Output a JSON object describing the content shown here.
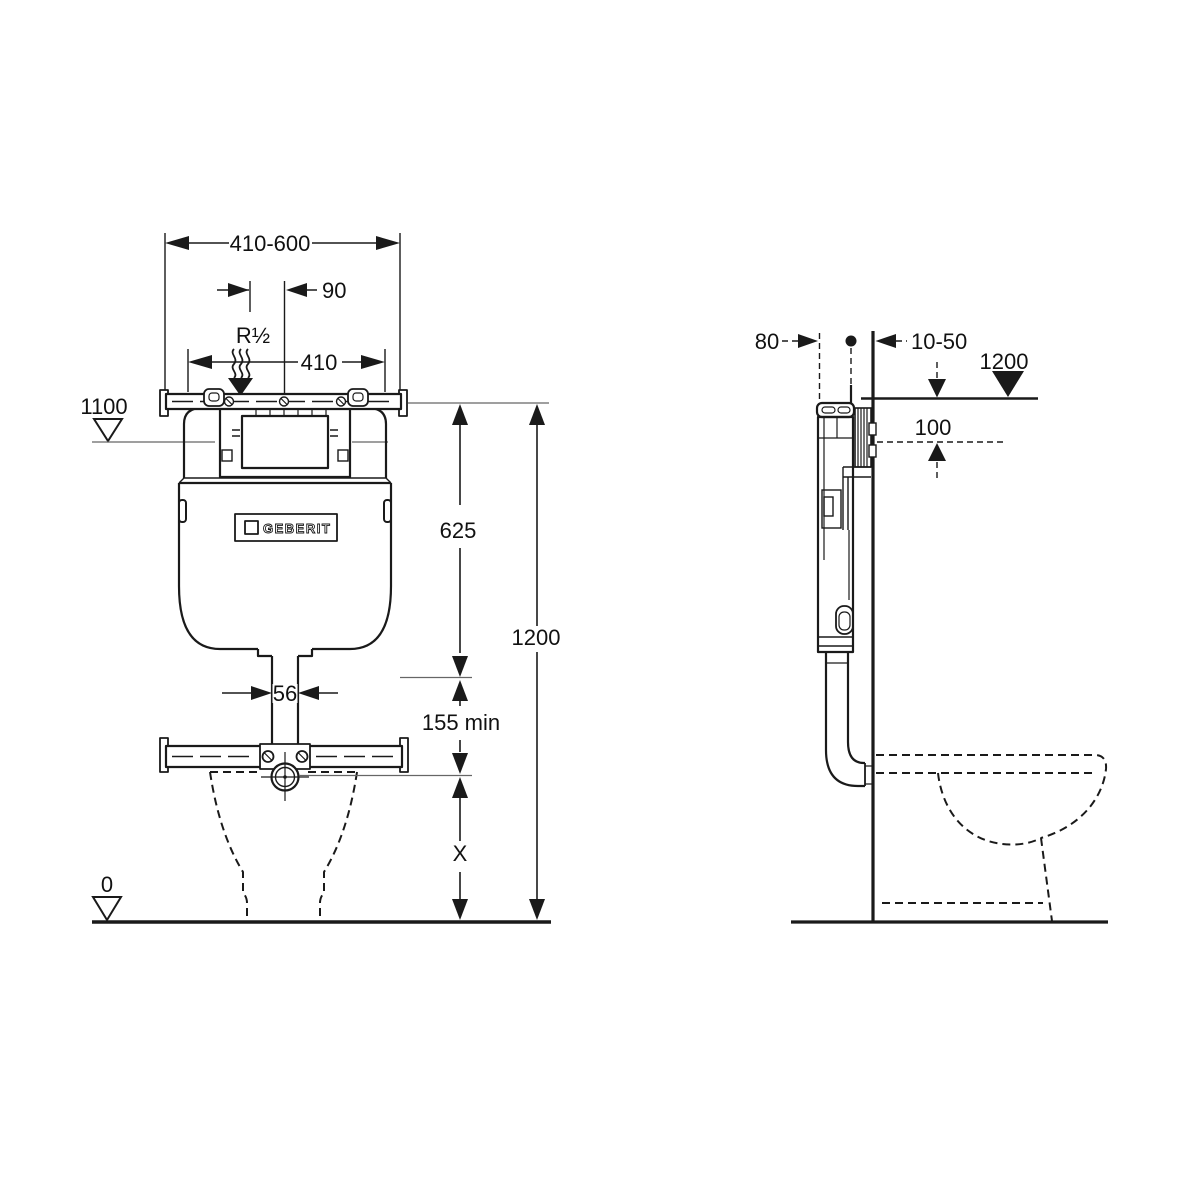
{
  "front_view": {
    "labels": {
      "width_range": "410-600",
      "offset": "90",
      "water_supply": "R½",
      "rail_width": "410",
      "upper_level": "1100",
      "cistern_height": "625",
      "overall_height": "1200",
      "outlet_width": "56",
      "min_clearance": "155 min",
      "variable_height": "X",
      "floor_level": "0"
    },
    "logo_text": "GEBERIT"
  },
  "side_view": {
    "labels": {
      "rough_in_depth": "80",
      "wall_finish_range": "10-50",
      "top_level": "1200",
      "top_offset": "100"
    }
  },
  "colors": {
    "line": "#1a1a1a",
    "reference_line": "#666666",
    "background": "#ffffff"
  }
}
